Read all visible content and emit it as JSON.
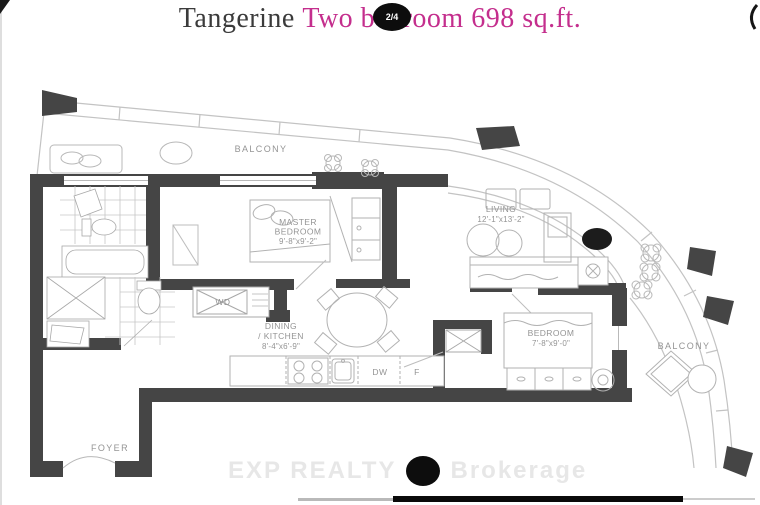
{
  "header": {
    "building_name": "Tangerine",
    "unit_title": "Two bedroom 698 sq.ft.",
    "photo_badge": "2/4"
  },
  "watermark": {
    "part1": "EXP REALTY",
    "part2": "Brokerage"
  },
  "rooms": {
    "master_bedroom": {
      "line1": "MASTER",
      "line2": "BEDROOM",
      "dims": "9'-8\"x9'-2\""
    },
    "living": {
      "line1": "LIVING",
      "dims": "12'-1\"x13'-2\""
    },
    "bedroom": {
      "line1": "BEDROOM",
      "dims": "7'-8\"x9'-0\""
    },
    "dining_kitchen": {
      "line1": "DINING",
      "line2": "/ KITCHEN",
      "dims": "8'-4\"x6'-9\""
    }
  },
  "labels": {
    "balcony_top": "BALCONY",
    "balcony_right": "BALCONY",
    "foyer": "FOYER",
    "washer_dryer": "WD",
    "dishwasher": "DW",
    "fridge": "F"
  },
  "colors": {
    "accent_pink": "#c42e8d",
    "title_dark": "#3b3b3b",
    "wall": "#454545",
    "line_gray": "#bdbdbd",
    "label_gray": "#949494",
    "badge_bg": "#0d0d0d",
    "watermark_gray": "#e5e5e5",
    "bottom_bar": "#0a0a0a"
  }
}
